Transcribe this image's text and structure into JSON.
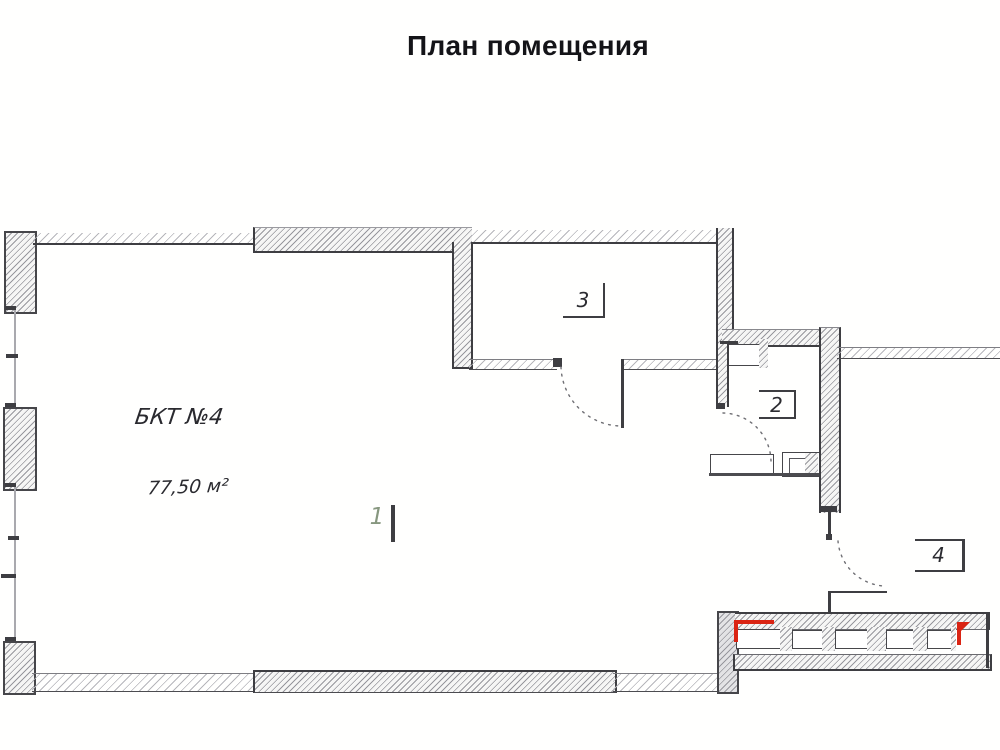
{
  "title": "План помещения",
  "plan": {
    "unit_label": "БКТ №4",
    "unit_area": "77,50 м²",
    "rooms": [
      {
        "number": "1"
      },
      {
        "number": "2"
      },
      {
        "number": "3"
      },
      {
        "number": "4"
      }
    ]
  },
  "colors": {
    "wall": "#3e3e42",
    "hatch": "#97979d",
    "accent_red": "#da2413",
    "room1_digit": "#87977f"
  }
}
